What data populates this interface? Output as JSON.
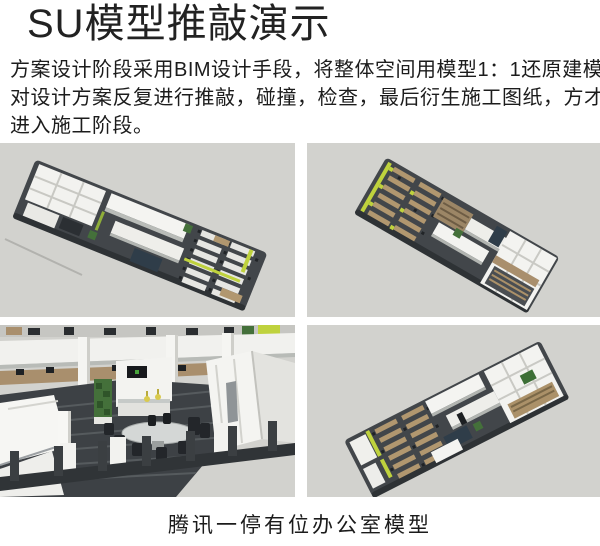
{
  "header": {
    "title": "SU模型推敲演示"
  },
  "body": {
    "lines": [
      "方案设计阶段采用BIM设计手段，将整体空间用模型1：1还原建模，",
      "对设计方案反复进行推敲，碰撞，检查，最后衍生施工图纸，方才",
      "进入施工阶段。"
    ]
  },
  "gallery": {
    "images": [
      {
        "name": "su-office-model-aerial-view-1"
      },
      {
        "name": "su-office-model-aerial-view-2"
      },
      {
        "name": "su-office-model-interior-view"
      },
      {
        "name": "su-office-model-aerial-view-3"
      }
    ]
  },
  "caption": {
    "text": "腾讯一停有位办公室模型"
  },
  "palette": {
    "page_bg": "#ffffff",
    "text": "#1f1f1f",
    "viewport_bg": "#d2d2ce",
    "floor_dark": "#42464a",
    "wall_white": "#f3f3f0",
    "wood": "#b1976f",
    "lime_accent": "#bfd23d",
    "plant_green": "#44703a",
    "navy_accent": "#2f3d49"
  }
}
